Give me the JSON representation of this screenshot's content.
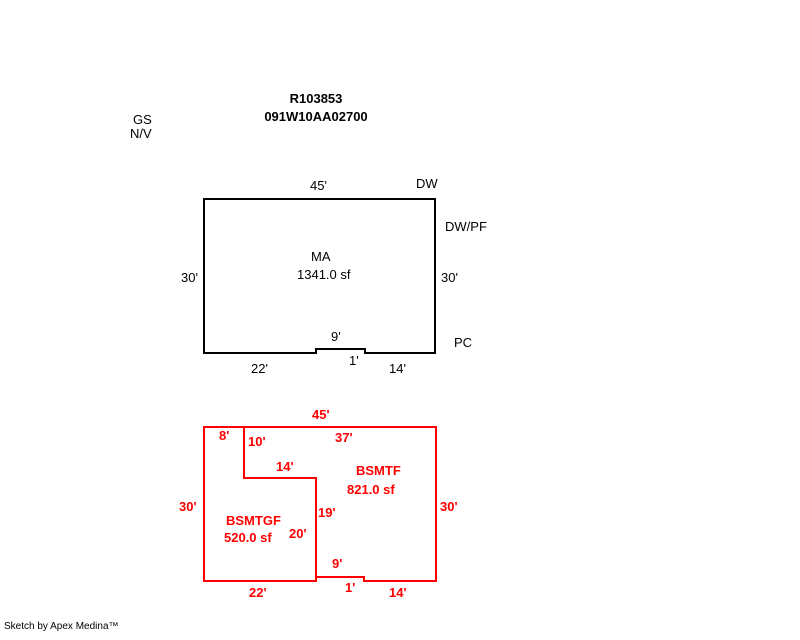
{
  "header": {
    "record_id": "R103853",
    "parcel_id": "091W10AA02700",
    "gs_label": "GS",
    "nv_label": "N/V"
  },
  "main_floor": {
    "name": "MA",
    "area": "1341.0 sf",
    "dims": {
      "top": "45'",
      "left": "30'",
      "right": "30'",
      "notch_width": "9'",
      "notch_depth": "1'",
      "bottom_left": "22'",
      "bottom_right": "14'"
    },
    "annotations": {
      "dw": "DW",
      "dwpf": "DW/PF",
      "pc": "PC"
    }
  },
  "basement": {
    "bsmtf": {
      "name": "BSMTF",
      "area": "821.0 sf"
    },
    "bsmtgf": {
      "name": "BSMTGF",
      "area": "520.0 sf"
    },
    "dims": {
      "top": "45'",
      "top_left_seg": "8'",
      "divider_v_upper": "10'",
      "top_main_seg": "37'",
      "divider_h": "14'",
      "left": "30'",
      "right": "30'",
      "divider_v_mid": "19'",
      "divider_v_lower": "20'",
      "notch_width": "9'",
      "notch_depth": "1'",
      "bottom_left": "22'",
      "bottom_right": "14'"
    }
  },
  "footer": {
    "credit": "Sketch by Apex Medina™"
  },
  "colors": {
    "main_floor_stroke": "#000000",
    "basement_stroke": "#ff0000",
    "background": "#ffffff"
  }
}
